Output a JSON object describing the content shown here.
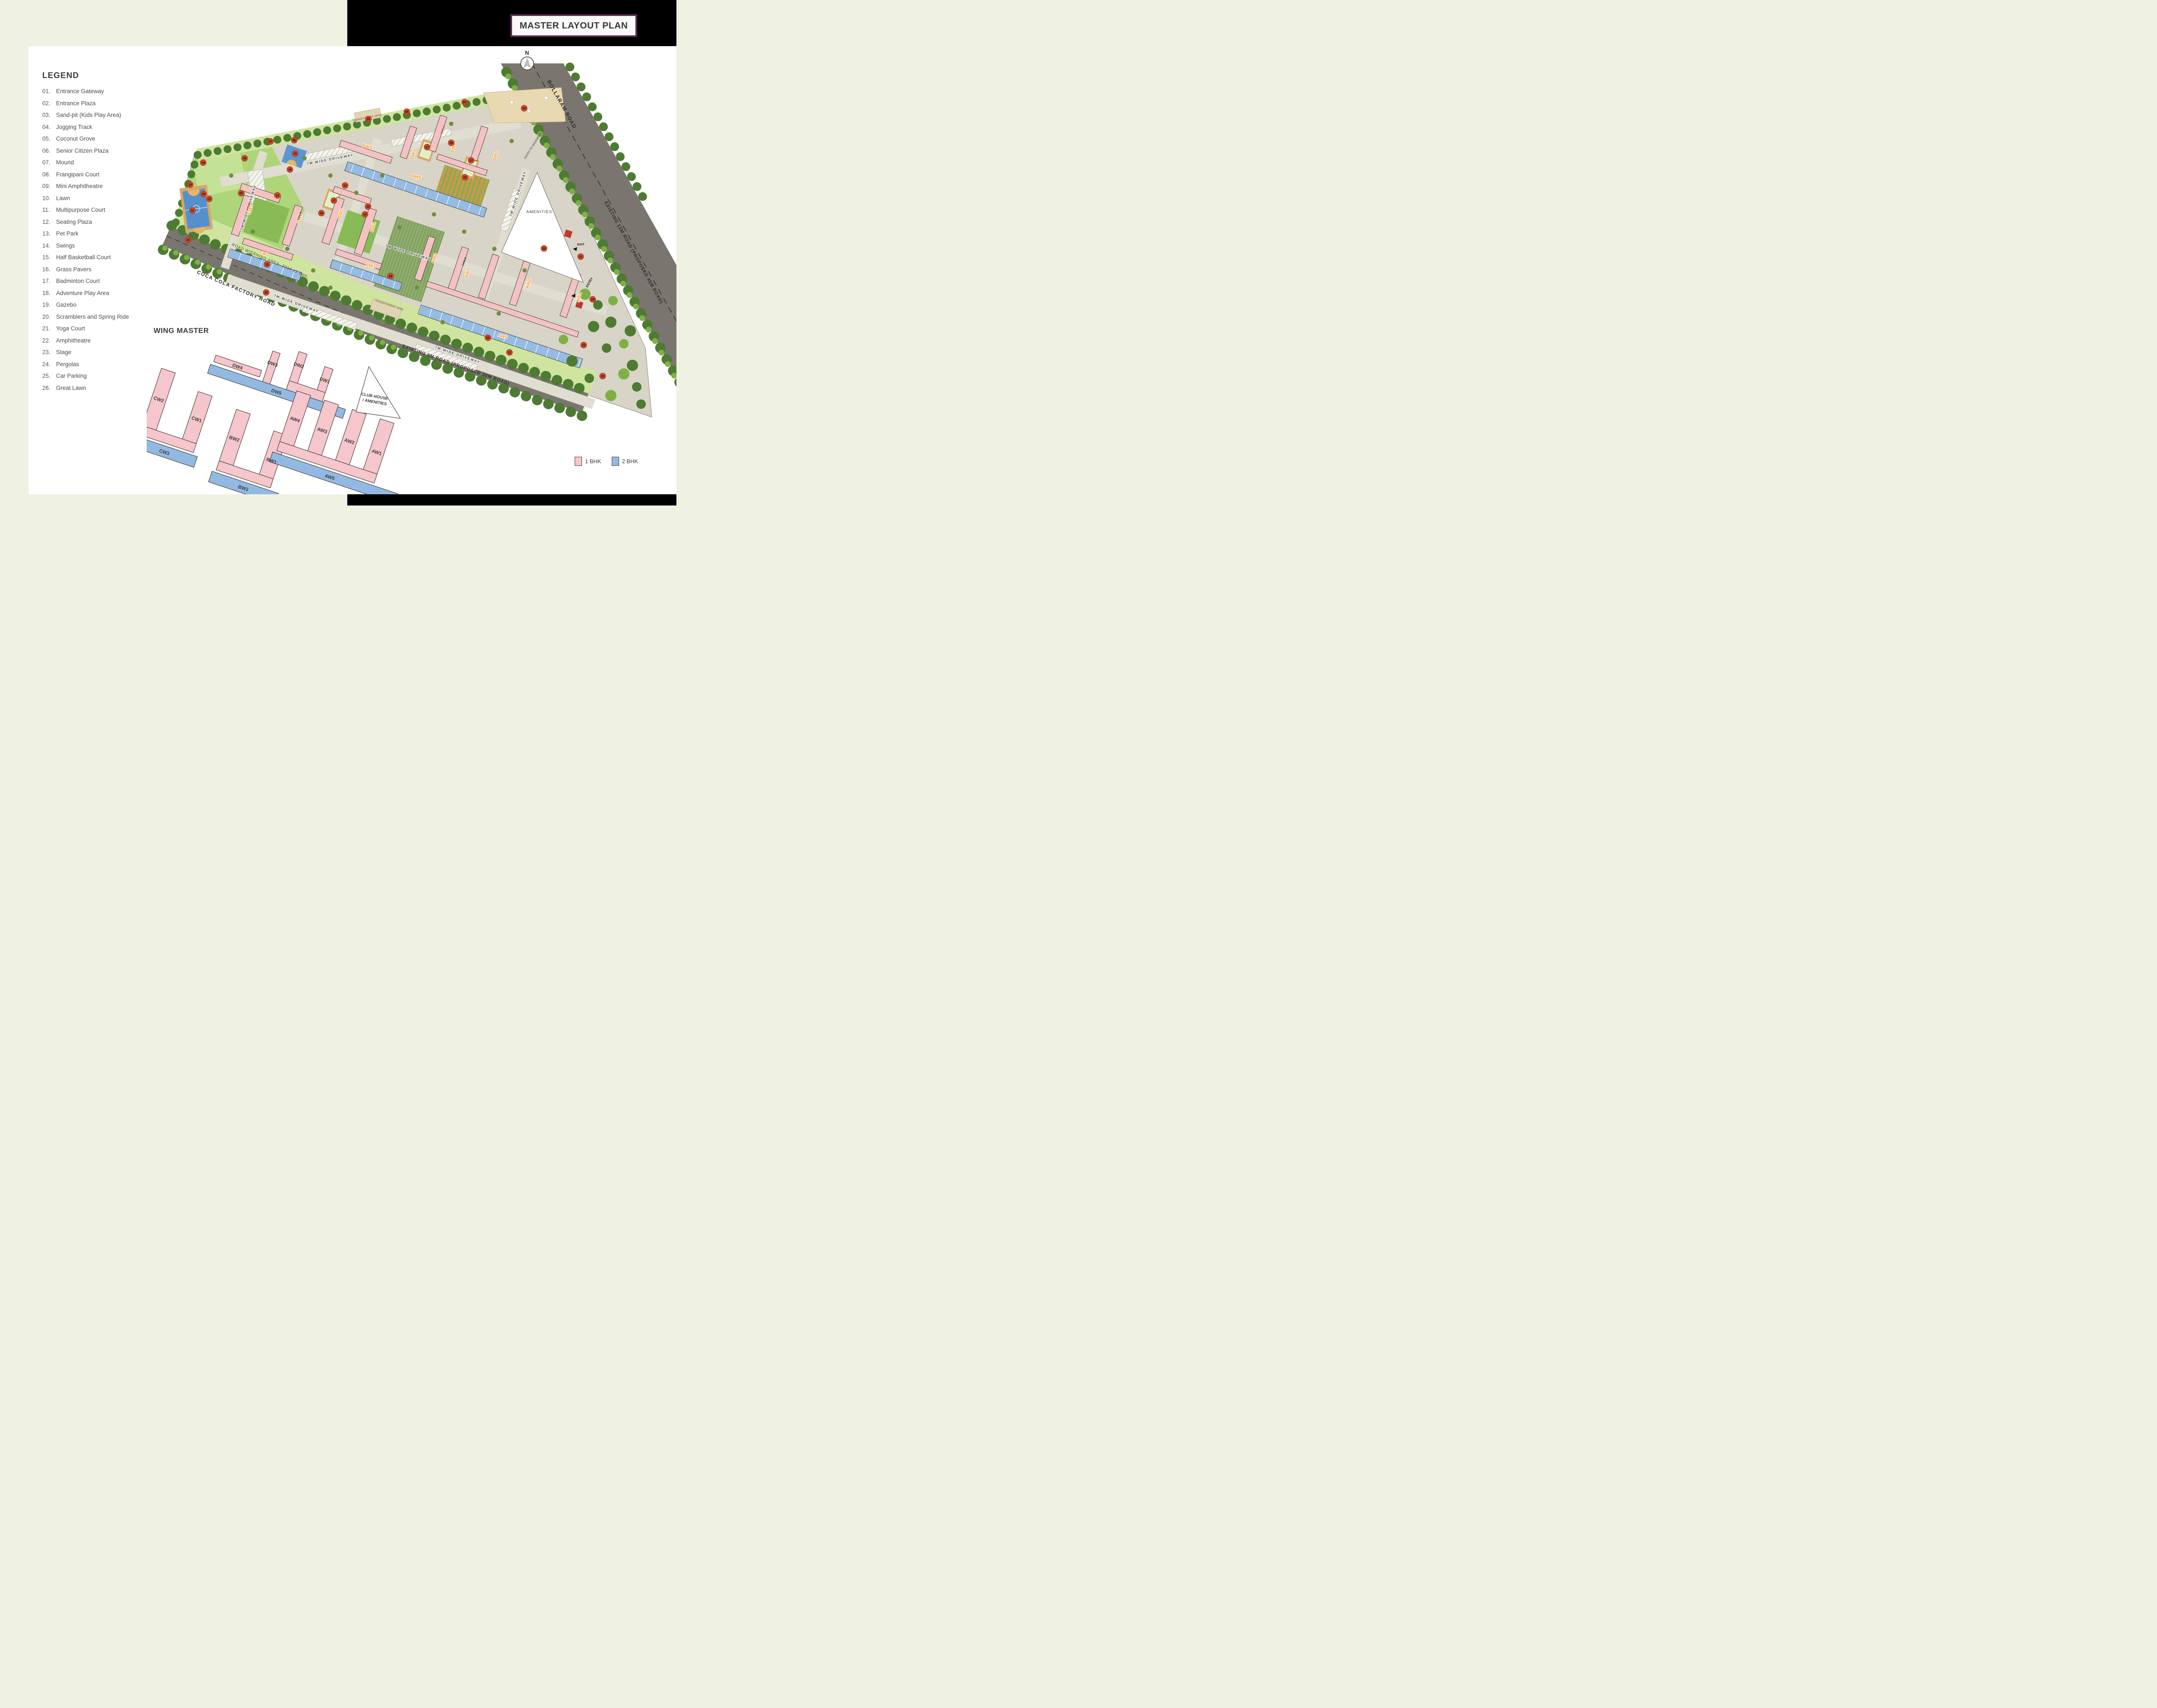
{
  "title": "MASTER LAYOUT PLAN",
  "compass_n": "N",
  "legend": {
    "heading": "LEGEND",
    "items": [
      {
        "num": "01.",
        "label": "Entrance Gateway"
      },
      {
        "num": "02.",
        "label": "Entrance Plaza"
      },
      {
        "num": "03.",
        "label": "Sand-pit (Kids Play Area)"
      },
      {
        "num": "04.",
        "label": "Jogging Track"
      },
      {
        "num": "05.",
        "label": "Coconut Grove"
      },
      {
        "num": "06.",
        "label": "Senior Citizen Plaza"
      },
      {
        "num": "07.",
        "label": "Mound"
      },
      {
        "num": "08.",
        "label": "Frangipani Court"
      },
      {
        "num": "09.",
        "label": "Mini Amphitheatre"
      },
      {
        "num": "10.",
        "label": "Lawn"
      },
      {
        "num": "11.",
        "label": "Multipurpose Court"
      },
      {
        "num": "12.",
        "label": "Seating Plaza"
      },
      {
        "num": "13.",
        "label": "Pet Park"
      },
      {
        "num": "14.",
        "label": "Swings"
      },
      {
        "num": "15.",
        "label": "Half Basketball Court"
      },
      {
        "num": "16.",
        "label": "Grass Pavers"
      },
      {
        "num": "17.",
        "label": "Badminton Court"
      },
      {
        "num": "18.",
        "label": "Adventure Play Area"
      },
      {
        "num": "19.",
        "label": "Gazebo"
      },
      {
        "num": "20.",
        "label": "Scramblers and Spring Ride"
      },
      {
        "num": "21.",
        "label": "Yoga Court"
      },
      {
        "num": "22.",
        "label": "Amphitheatre"
      },
      {
        "num": "23.",
        "label": "Stage"
      },
      {
        "num": "24.",
        "label": "Pergolas"
      },
      {
        "num": "25.",
        "label": "Car Parking"
      },
      {
        "num": "26.",
        "label": "Great Lawn"
      }
    ]
  },
  "wing_master_heading": "WING MASTER",
  "wings": {
    "dw1": "DW1",
    "dw2": "DW2",
    "dw3": "DW3",
    "dw4": "DW4",
    "dw5": "DW5",
    "cw1": "CW1",
    "cw2": "CW2",
    "cw3": "CW3",
    "bw1": "BW1",
    "bw2": "BW2",
    "bw3": "BW3",
    "aw1": "AW1",
    "aw2": "AW2",
    "aw3": "AW3",
    "aw4": "AW4",
    "aw5": "AW5"
  },
  "club_house_line1": "CLUB HOUSE",
  "club_house_line2": "/ AMENITIES",
  "bhk_legend": {
    "one": "1 BHK",
    "two": "2 BHK"
  },
  "map": {
    "roads": {
      "bollaram": "BOLLARAM ROAD",
      "existing12": "EXISTING 12M ROAD  (PROPOSED 45M ROAD)",
      "coca": "COCA COLA FACTORY ROAD",
      "existing9": "EXISTING 9M ROAD  (PROPOSED 30M ROAD)",
      "widening": "ROAD WIDENING AREA- 3334.11 Sqm."
    },
    "driveway_label": "7M WIDE DRIVEWAY",
    "amenities": "AMENITIES",
    "transformer_yard": "TRANSFORMER YARD",
    "entry_to_basement": "ENTRY TO BASEMENT",
    "exit": "EXIT",
    "entry": "ENTRY",
    "type_a": "TYPE-A",
    "type_b": "TYPE-B",
    "badges": [
      "01",
      "02",
      "02",
      "03",
      "04",
      "04",
      "05",
      "05",
      "06",
      "07",
      "08",
      "09",
      "10",
      "11",
      "12",
      "12",
      "13",
      "14",
      "15",
      "16",
      "16",
      "17",
      "17",
      "17",
      "18",
      "19",
      "19",
      "20",
      "21",
      "22",
      "23",
      "24",
      "25",
      "25",
      "25",
      "26"
    ]
  },
  "colors": {
    "accent_purple": "#572a52",
    "pink_1bhk": "#f5c6cb",
    "blue_2bhk": "#92b9e2",
    "road_gray": "#7b756f",
    "tree_green": "#4e7b33",
    "wing_label_orange": "#f5941e",
    "badge_red": "#cf4a2e"
  }
}
